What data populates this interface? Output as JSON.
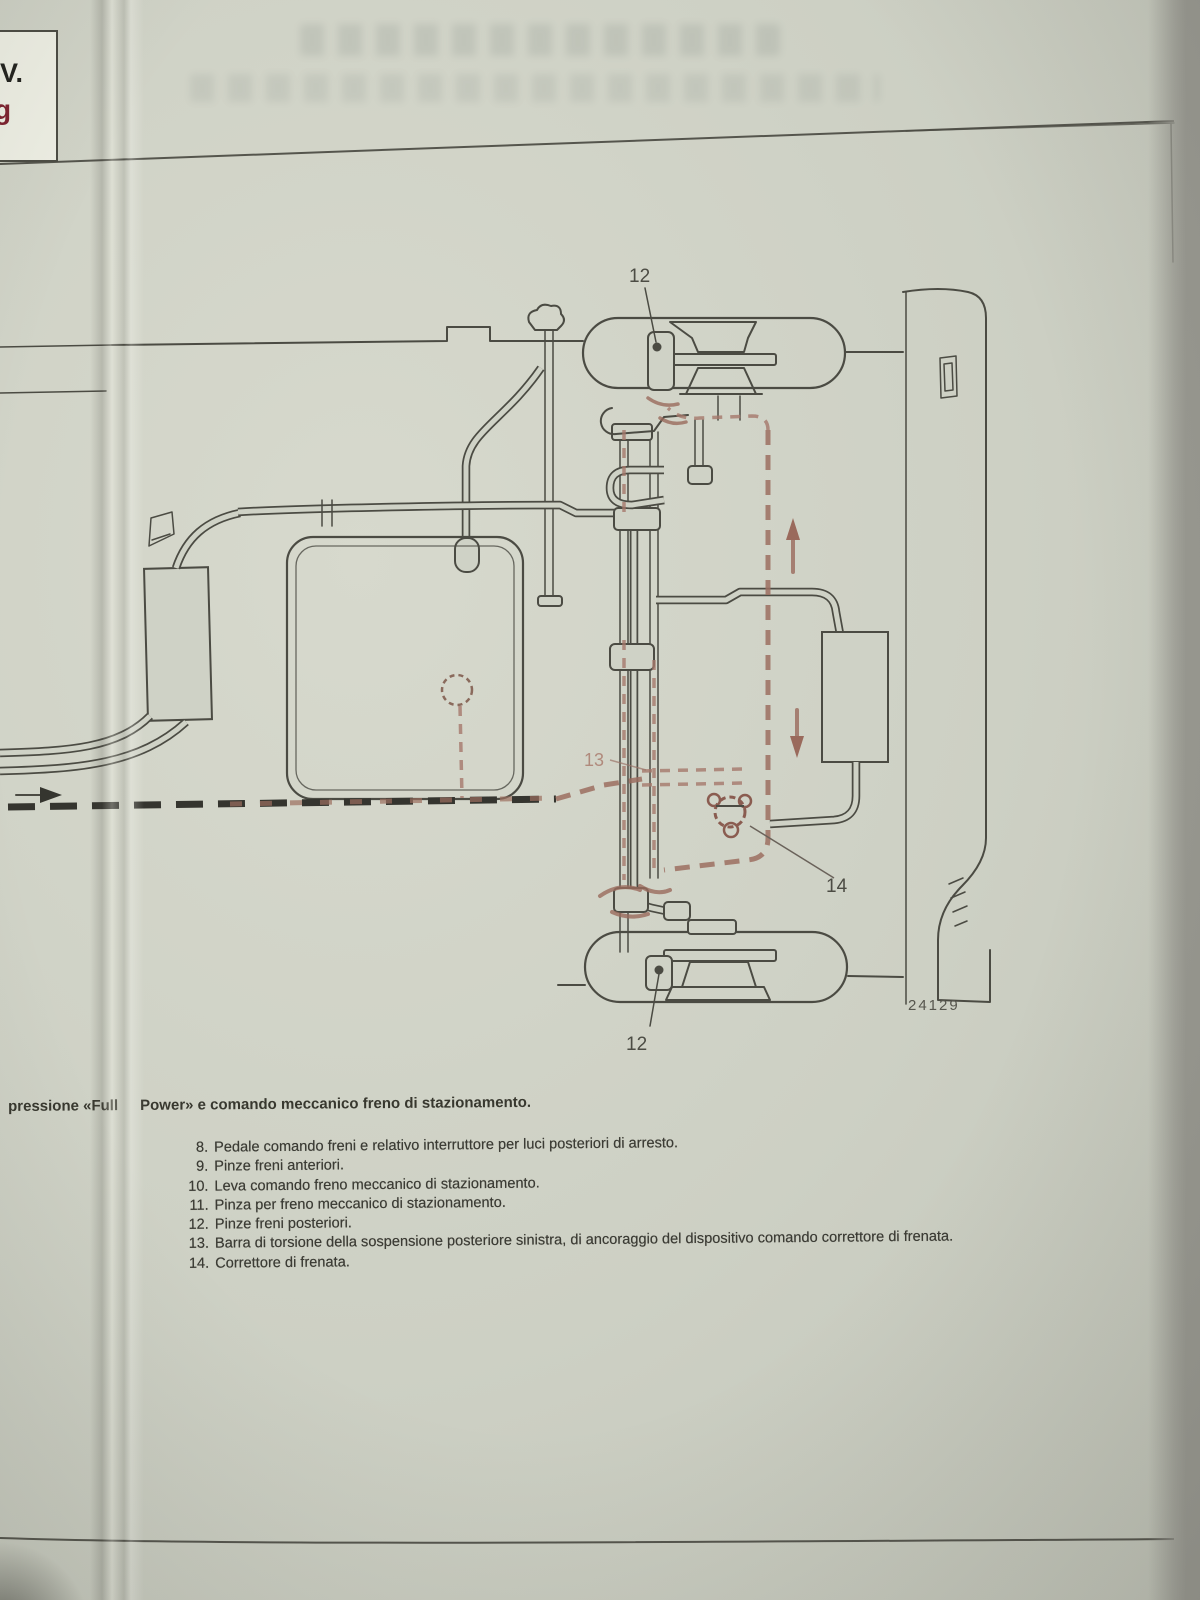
{
  "document": {
    "corner_box": {
      "line1": "V.",
      "line2": "g"
    },
    "figure": {
      "number": "24129",
      "callouts": {
        "top_caliper": "12",
        "torsion_bar": "13",
        "corrector": "14",
        "bottom_caliper": "12"
      }
    },
    "caption": {
      "lead": "pressione «Full",
      "rest": "Power» e comando meccanico freno di stazionamento."
    },
    "legend": [
      {
        "num": "8.",
        "text": "Pedale comando freni e relativo interruttore per luci posteriori di arresto."
      },
      {
        "num": "9.",
        "text": "Pinze freni anteriori."
      },
      {
        "num": "10.",
        "text": "Leva comando freno meccanico di stazionamento."
      },
      {
        "num": "11.",
        "text": "Pinza per freno meccanico di stazionamento."
      },
      {
        "num": "12.",
        "text": "Pinze freni posteriori."
      },
      {
        "num": "13.",
        "text": "Barra di torsione della sospensione posteriore sinistra, di ancoraggio del dispositivo comando correttore di frenata."
      },
      {
        "num": "14.",
        "text": "Correttore di frenata."
      }
    ],
    "colors": {
      "paper": "#cdd0c4",
      "ink": "#4b4b43",
      "highlight": "#9c6f60",
      "corner_accent": "#7e2430"
    }
  }
}
